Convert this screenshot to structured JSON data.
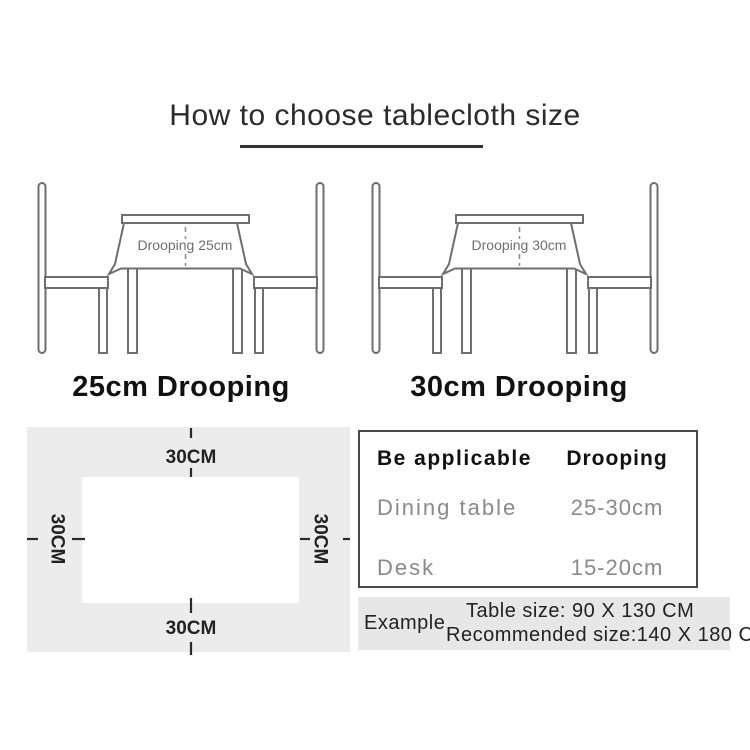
{
  "title": "How to choose tablecloth size",
  "scenes": [
    {
      "drooping_label": "Drooping 25cm",
      "caption": "25cm Drooping"
    },
    {
      "drooping_label": "Drooping 30cm",
      "caption": "30cm Drooping"
    }
  ],
  "size_diagram": {
    "top_label": "30CM",
    "bottom_label": "30CM",
    "left_label": "30CM",
    "right_label": "30CM"
  },
  "spec_table": {
    "headers": [
      "Be applicable",
      "Drooping"
    ],
    "rows": [
      {
        "name": "Dining table",
        "value": "25-30cm"
      },
      {
        "name": "Desk",
        "value": "15-20cm"
      }
    ]
  },
  "example": {
    "label": "Example",
    "line1": "Table size: 90 X 130 CM",
    "line2": "Recommended size:140 X 180 CM"
  },
  "colors": {
    "line_gray": "#6e6e6e",
    "text_gray": "#8a8a8a",
    "panel_gray": "#ececec",
    "example_bg": "#e7e7e7",
    "dark_text": "#222222"
  }
}
